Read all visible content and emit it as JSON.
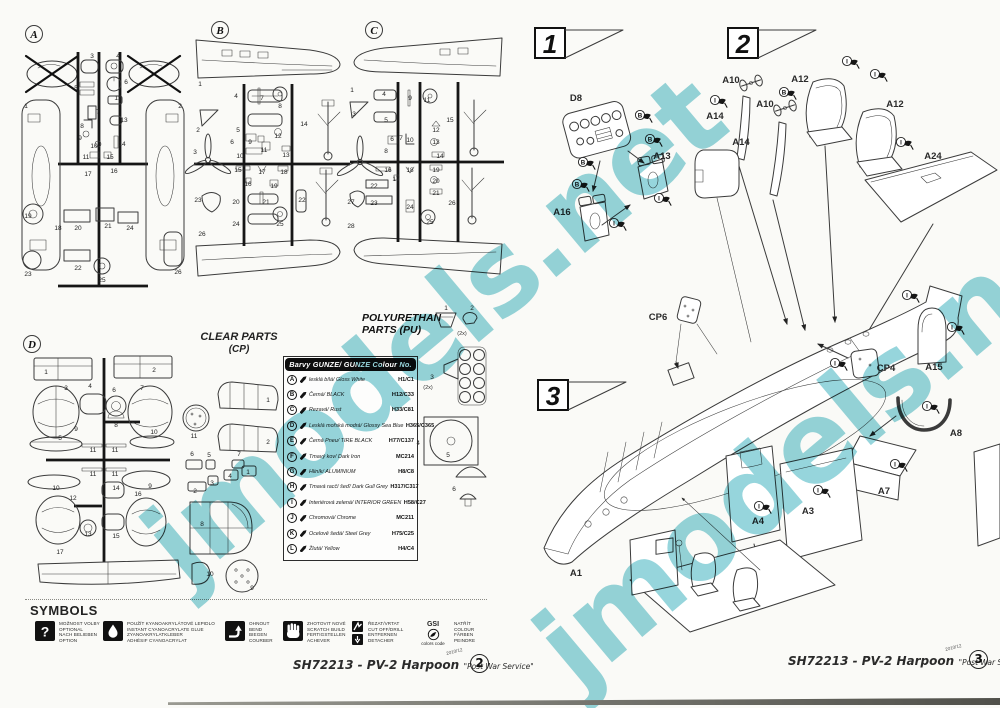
{
  "watermark": {
    "text": "jmodels.net",
    "color": "#7fccd4"
  },
  "ink_color": "#3b3b3b",
  "pages": {
    "left": {
      "footer": {
        "code": "SH72213 - PV-2 Harpoon",
        "service": "\"Post War Service\"",
        "date": "2010/12",
        "page": "2"
      }
    },
    "right": {
      "footer": {
        "code": "SH72213 - PV-2 Harpoon",
        "service": "\"Post War Service\"",
        "date": "2010/12",
        "page": "3"
      }
    }
  },
  "sprues": {
    "a": {
      "id": "A",
      "labels": [
        {
          "t": "1",
          "x": 8,
          "y": 90
        },
        {
          "t": "2",
          "x": 162,
          "y": 90
        },
        {
          "t": "3",
          "x": 74,
          "y": 40
        },
        {
          "t": "4",
          "x": 100,
          "y": 40
        },
        {
          "t": "5",
          "x": 58,
          "y": 72
        },
        {
          "t": "6",
          "x": 108,
          "y": 66
        },
        {
          "t": "7",
          "x": 80,
          "y": 96
        },
        {
          "t": "12",
          "x": 100,
          "y": 82
        },
        {
          "t": "8",
          "x": 64,
          "y": 110
        },
        {
          "t": "13",
          "x": 106,
          "y": 104
        },
        {
          "t": "9",
          "x": 62,
          "y": 122
        },
        {
          "t": "10",
          "x": 76,
          "y": 130
        },
        {
          "t": "14",
          "x": 104,
          "y": 128
        },
        {
          "t": "11",
          "x": 68,
          "y": 141
        },
        {
          "t": "15",
          "x": 92,
          "y": 141
        },
        {
          "t": "16",
          "x": 96,
          "y": 155
        },
        {
          "t": "17",
          "x": 70,
          "y": 158
        },
        {
          "t": "18",
          "x": 40,
          "y": 212
        },
        {
          "t": "19",
          "x": 10,
          "y": 200
        },
        {
          "t": "20",
          "x": 60,
          "y": 212
        },
        {
          "t": "21",
          "x": 90,
          "y": 210
        },
        {
          "t": "22",
          "x": 60,
          "y": 252
        },
        {
          "t": "23",
          "x": 10,
          "y": 258
        },
        {
          "t": "24",
          "x": 112,
          "y": 212
        },
        {
          "t": "25",
          "x": 84,
          "y": 264
        },
        {
          "t": "26",
          "x": 160,
          "y": 256
        }
      ]
    },
    "b": {
      "id": "B",
      "labels": [
        {
          "t": "1",
          "x": 8,
          "y": 72
        },
        {
          "t": "2",
          "x": 6,
          "y": 118
        },
        {
          "t": "3",
          "x": 3,
          "y": 140
        },
        {
          "t": "4",
          "x": 44,
          "y": 84
        },
        {
          "t": "5",
          "x": 46,
          "y": 118
        },
        {
          "t": "6",
          "x": 40,
          "y": 130
        },
        {
          "t": "7",
          "x": 70,
          "y": 86
        },
        {
          "t": "8",
          "x": 88,
          "y": 94
        },
        {
          "t": "9",
          "x": 58,
          "y": 130
        },
        {
          "t": "10",
          "x": 48,
          "y": 144
        },
        {
          "t": "11",
          "x": 72,
          "y": 138
        },
        {
          "t": "12",
          "x": 86,
          "y": 124
        },
        {
          "t": "13",
          "x": 94,
          "y": 143
        },
        {
          "t": "14",
          "x": 112,
          "y": 112
        },
        {
          "t": "15",
          "x": 46,
          "y": 158
        },
        {
          "t": "16",
          "x": 56,
          "y": 172
        },
        {
          "t": "17",
          "x": 70,
          "y": 160
        },
        {
          "t": "18",
          "x": 92,
          "y": 160
        },
        {
          "t": "19",
          "x": 82,
          "y": 174
        },
        {
          "t": "20",
          "x": 44,
          "y": 190
        },
        {
          "t": "21",
          "x": 74,
          "y": 190
        },
        {
          "t": "22",
          "x": 110,
          "y": 188
        },
        {
          "t": "23",
          "x": 6,
          "y": 188
        },
        {
          "t": "24",
          "x": 44,
          "y": 212
        },
        {
          "t": "25",
          "x": 88,
          "y": 212
        },
        {
          "t": "26",
          "x": 10,
          "y": 222
        }
      ]
    },
    "c": {
      "id": "C",
      "labels": [
        {
          "t": "1",
          "x": 4,
          "y": 78
        },
        {
          "t": "3",
          "x": 6,
          "y": 102
        },
        {
          "t": "4",
          "x": 36,
          "y": 82
        },
        {
          "t": "5",
          "x": 38,
          "y": 108
        },
        {
          "t": "6",
          "x": 44,
          "y": 127
        },
        {
          "t": "7",
          "x": 53,
          "y": 126
        },
        {
          "t": "8",
          "x": 38,
          "y": 139
        },
        {
          "t": "9",
          "x": 62,
          "y": 86
        },
        {
          "t": "10",
          "x": 62,
          "y": 128
        },
        {
          "t": "11",
          "x": 79,
          "y": 88
        },
        {
          "t": "12",
          "x": 88,
          "y": 118
        },
        {
          "t": "13",
          "x": 88,
          "y": 130
        },
        {
          "t": "14",
          "x": 92,
          "y": 144
        },
        {
          "t": "15",
          "x": 102,
          "y": 108
        },
        {
          "t": "16",
          "x": 40,
          "y": 158
        },
        {
          "t": "17",
          "x": 48,
          "y": 167
        },
        {
          "t": "18",
          "x": 62,
          "y": 158
        },
        {
          "t": "19",
          "x": 88,
          "y": 158
        },
        {
          "t": "20",
          "x": 88,
          "y": 169
        },
        {
          "t": "21",
          "x": 88,
          "y": 181
        },
        {
          "t": "22",
          "x": 26,
          "y": 174
        },
        {
          "t": "23",
          "x": 26,
          "y": 191
        },
        {
          "t": "24",
          "x": 62,
          "y": 195
        },
        {
          "t": "25",
          "x": 82,
          "y": 210
        },
        {
          "t": "26",
          "x": 104,
          "y": 191
        },
        {
          "t": "27",
          "x": 3,
          "y": 190
        },
        {
          "t": "28",
          "x": 3,
          "y": 214
        }
      ]
    },
    "d": {
      "id": "D",
      "labels": [
        {
          "t": "1",
          "x": 28,
          "y": 44
        },
        {
          "t": "2",
          "x": 136,
          "y": 42
        },
        {
          "t": "3",
          "x": 48,
          "y": 60
        },
        {
          "t": "4",
          "x": 72,
          "y": 58
        },
        {
          "t": "6",
          "x": 96,
          "y": 62
        },
        {
          "t": "7",
          "x": 124,
          "y": 60
        },
        {
          "t": "5",
          "x": 42,
          "y": 110
        },
        {
          "t": "8",
          "x": 98,
          "y": 97
        },
        {
          "t": "9",
          "x": 58,
          "y": 101
        },
        {
          "t": "10",
          "x": 136,
          "y": 104
        },
        {
          "t": "11",
          "x": 75,
          "y": 122
        },
        {
          "t": "11",
          "x": 97,
          "y": 122
        },
        {
          "t": "11",
          "x": 75,
          "y": 146
        },
        {
          "t": "11",
          "x": 97,
          "y": 146
        },
        {
          "t": "10",
          "x": 38,
          "y": 160
        },
        {
          "t": "9",
          "x": 132,
          "y": 158
        },
        {
          "t": "12",
          "x": 55,
          "y": 170
        },
        {
          "t": "14",
          "x": 98,
          "y": 160
        },
        {
          "t": "16",
          "x": 120,
          "y": 166
        },
        {
          "t": "13",
          "x": 70,
          "y": 206
        },
        {
          "t": "15",
          "x": 98,
          "y": 208
        },
        {
          "t": "17",
          "x": 42,
          "y": 224
        }
      ]
    }
  },
  "clear_parts": {
    "title": "CLEAR PARTS",
    "subtitle": "(CP)",
    "labels": [
      {
        "t": "11",
        "x": 14,
        "y": 86
      },
      {
        "t": "1",
        "x": 88,
        "y": 50
      },
      {
        "t": "2",
        "x": 88,
        "y": 92
      },
      {
        "t": "6",
        "x": 12,
        "y": 104
      },
      {
        "t": "5",
        "x": 29,
        "y": 105
      },
      {
        "t": "7",
        "x": 59,
        "y": 104
      },
      {
        "t": "2",
        "x": 15,
        "y": 141
      },
      {
        "t": "3",
        "x": 32,
        "y": 133
      },
      {
        "t": "4",
        "x": 50,
        "y": 126
      },
      {
        "t": "1",
        "x": 68,
        "y": 122
      },
      {
        "t": "8",
        "x": 22,
        "y": 174
      },
      {
        "t": "10",
        "x": 30,
        "y": 224
      },
      {
        "t": "9",
        "x": 72,
        "y": 238
      }
    ]
  },
  "pu_parts": {
    "title1": "POLYURETHAN",
    "title2": "PARTS (PU)",
    "labels": [
      {
        "t": "1",
        "x": 86,
        "y": 5
      },
      {
        "t": "2",
        "x": 112,
        "y": 5
      },
      {
        "t": "(2x)",
        "x": 102,
        "y": 30,
        "c": "pns"
      },
      {
        "t": "3",
        "x": 72,
        "y": 74
      },
      {
        "t": "(2x)",
        "x": 68,
        "y": 84,
        "c": "pns"
      },
      {
        "t": "4",
        "x": 58,
        "y": 140
      },
      {
        "t": "5",
        "x": 88,
        "y": 152
      },
      {
        "t": "6",
        "x": 94,
        "y": 186
      }
    ]
  },
  "color_table": {
    "header": "Barvy GUNZE/ GUNZE Colour No.",
    "rows": [
      {
        "letter": "A",
        "name": "lesklá bílá/ Gloss White",
        "code": "H1/C1"
      },
      {
        "letter": "B",
        "name": "Černá/ BLACK",
        "code": "H12/C33"
      },
      {
        "letter": "C",
        "name": "Rezavá/ Rust",
        "code": "H33/C81"
      },
      {
        "letter": "D",
        "name": "Lesklá mořská modrá/ Glossy Sea Blue",
        "code": "H365/C365"
      },
      {
        "letter": "E",
        "name": "Černá Pneu/ TIRE BLACK",
        "code": "H77/C137"
      },
      {
        "letter": "F",
        "name": "Tmavý kov/ Dark Iron",
        "code": "MC214"
      },
      {
        "letter": "G",
        "name": "Hliník/ ALUMINIUM",
        "code": "H8/C8"
      },
      {
        "letter": "H",
        "name": "Tmavá racčí šeď/ Dark Gull Grey",
        "code": "H317/C317"
      },
      {
        "letter": "I",
        "name": "Interiérová zelená/ INTERIOR GREEN",
        "code": "H58/C27"
      },
      {
        "letter": "J",
        "name": "Chromová/ Chrome",
        "code": "MC211"
      },
      {
        "letter": "K",
        "name": "Ocelově šedá/ Steel Grey",
        "code": "H75/C25"
      },
      {
        "letter": "L",
        "name": "Žlutá/ Yellow",
        "code": "H4/C4"
      }
    ]
  },
  "symbols": {
    "title": "SYMBOLS",
    "items": [
      {
        "icon": "question",
        "x": 35,
        "lines": [
          "MOŽNOST VOLBY",
          "OPTIONAL",
          "NACH BELIEBEN",
          "OPTION"
        ]
      },
      {
        "icon": "drop",
        "x": 103,
        "lines": [
          "POUŽÍT KYANOAKRYLÁTOVÉ LEPIDLO",
          "INSTANT CYANOACRYLATE GLUE",
          "ZYANOAKRYLATKLEBER",
          "ADHÉSIF CYANOACRYLAT"
        ]
      },
      {
        "icon": "bend",
        "x": 225,
        "lines": [
          "OHNOUT",
          "BEND",
          "BIEGEN",
          "COURBER"
        ]
      },
      {
        "icon": "scratch",
        "x": 283,
        "lines": [
          "ZHOTOVIT NOVÉ",
          "SCRATCH BUILD",
          "FERTIGSTELLEN",
          "ACHEVER"
        ]
      },
      {
        "icon": "cut",
        "x": 352,
        "lines": [
          "ŘEZAT/VRTAT",
          "CUT OFF/DRILL",
          "ENTFERNEN",
          "DETACHER"
        ]
      },
      {
        "icon": "gsi",
        "x": 416,
        "label": "GSI",
        "sublabel": "colors code",
        "lines": [
          "NATŘÍT",
          "COLOUR",
          "FÄRBEN",
          "PEINDRE"
        ]
      }
    ]
  },
  "steps": {
    "s1": {
      "flag": "1",
      "labels": [
        {
          "t": "D8",
          "x": 36,
          "y": 36,
          "c": "plabel"
        },
        {
          "t": "A16",
          "x": 22,
          "y": 150,
          "c": "plabel"
        },
        {
          "t": "A13",
          "x": 122,
          "y": 94,
          "c": "plabel"
        }
      ],
      "callouts": [
        {
          "l": "B",
          "x": 100,
          "y": 50
        },
        {
          "l": "B",
          "x": 43,
          "y": 97
        },
        {
          "l": "B",
          "x": 110,
          "y": 74
        },
        {
          "l": "B",
          "x": 37,
          "y": 119
        },
        {
          "l": "I",
          "x": 119,
          "y": 133
        },
        {
          "l": "I",
          "x": 74,
          "y": 158
        }
      ]
    },
    "s2": {
      "flag": "2",
      "labels": [
        {
          "t": "A10",
          "x": 36,
          "y": 33,
          "c": "plabel"
        },
        {
          "t": "A14",
          "x": 20,
          "y": 69,
          "c": "plabel"
        },
        {
          "t": "A10",
          "x": 70,
          "y": 57,
          "c": "plabel"
        },
        {
          "t": "A14",
          "x": 46,
          "y": 95,
          "c": "plabel"
        },
        {
          "t": "A12",
          "x": 105,
          "y": 32,
          "c": "plabel"
        },
        {
          "t": "A12",
          "x": 200,
          "y": 57,
          "c": "plabel"
        },
        {
          "t": "A24",
          "x": 238,
          "y": 109,
          "c": "plabel"
        }
      ],
      "callouts": [
        {
          "l": "I",
          "x": 20,
          "y": 50
        },
        {
          "l": "B",
          "x": 89,
          "y": 42
        },
        {
          "l": "I",
          "x": 152,
          "y": 11
        },
        {
          "l": "I",
          "x": 180,
          "y": 24
        },
        {
          "l": "I",
          "x": 206,
          "y": 92
        }
      ]
    },
    "s3": {
      "flag": "3",
      "labels": [
        {
          "t": "CP6",
          "x": 128,
          "y": 80,
          "c": "plabel"
        },
        {
          "t": "CP4",
          "x": 356,
          "y": 131,
          "c": "plabel"
        },
        {
          "t": "A15",
          "x": 404,
          "y": 130,
          "c": "plabel"
        },
        {
          "t": "A8",
          "x": 426,
          "y": 196,
          "c": "plabel"
        },
        {
          "t": "A7",
          "x": 354,
          "y": 254,
          "c": "plabel"
        },
        {
          "t": "A3",
          "x": 278,
          "y": 274,
          "c": "plabel"
        },
        {
          "t": "A4",
          "x": 228,
          "y": 284,
          "c": "plabel"
        },
        {
          "t": "A1",
          "x": 46,
          "y": 336,
          "c": "plabel"
        }
      ],
      "callouts": [
        {
          "l": "I",
          "x": 377,
          "y": 55
        },
        {
          "l": "I",
          "x": 305,
          "y": 123
        },
        {
          "l": "I",
          "x": 422,
          "y": 87
        },
        {
          "l": "I",
          "x": 397,
          "y": 166
        },
        {
          "l": "I",
          "x": 365,
          "y": 224
        },
        {
          "l": "I",
          "x": 288,
          "y": 250
        },
        {
          "l": "I",
          "x": 229,
          "y": 266
        }
      ]
    }
  }
}
